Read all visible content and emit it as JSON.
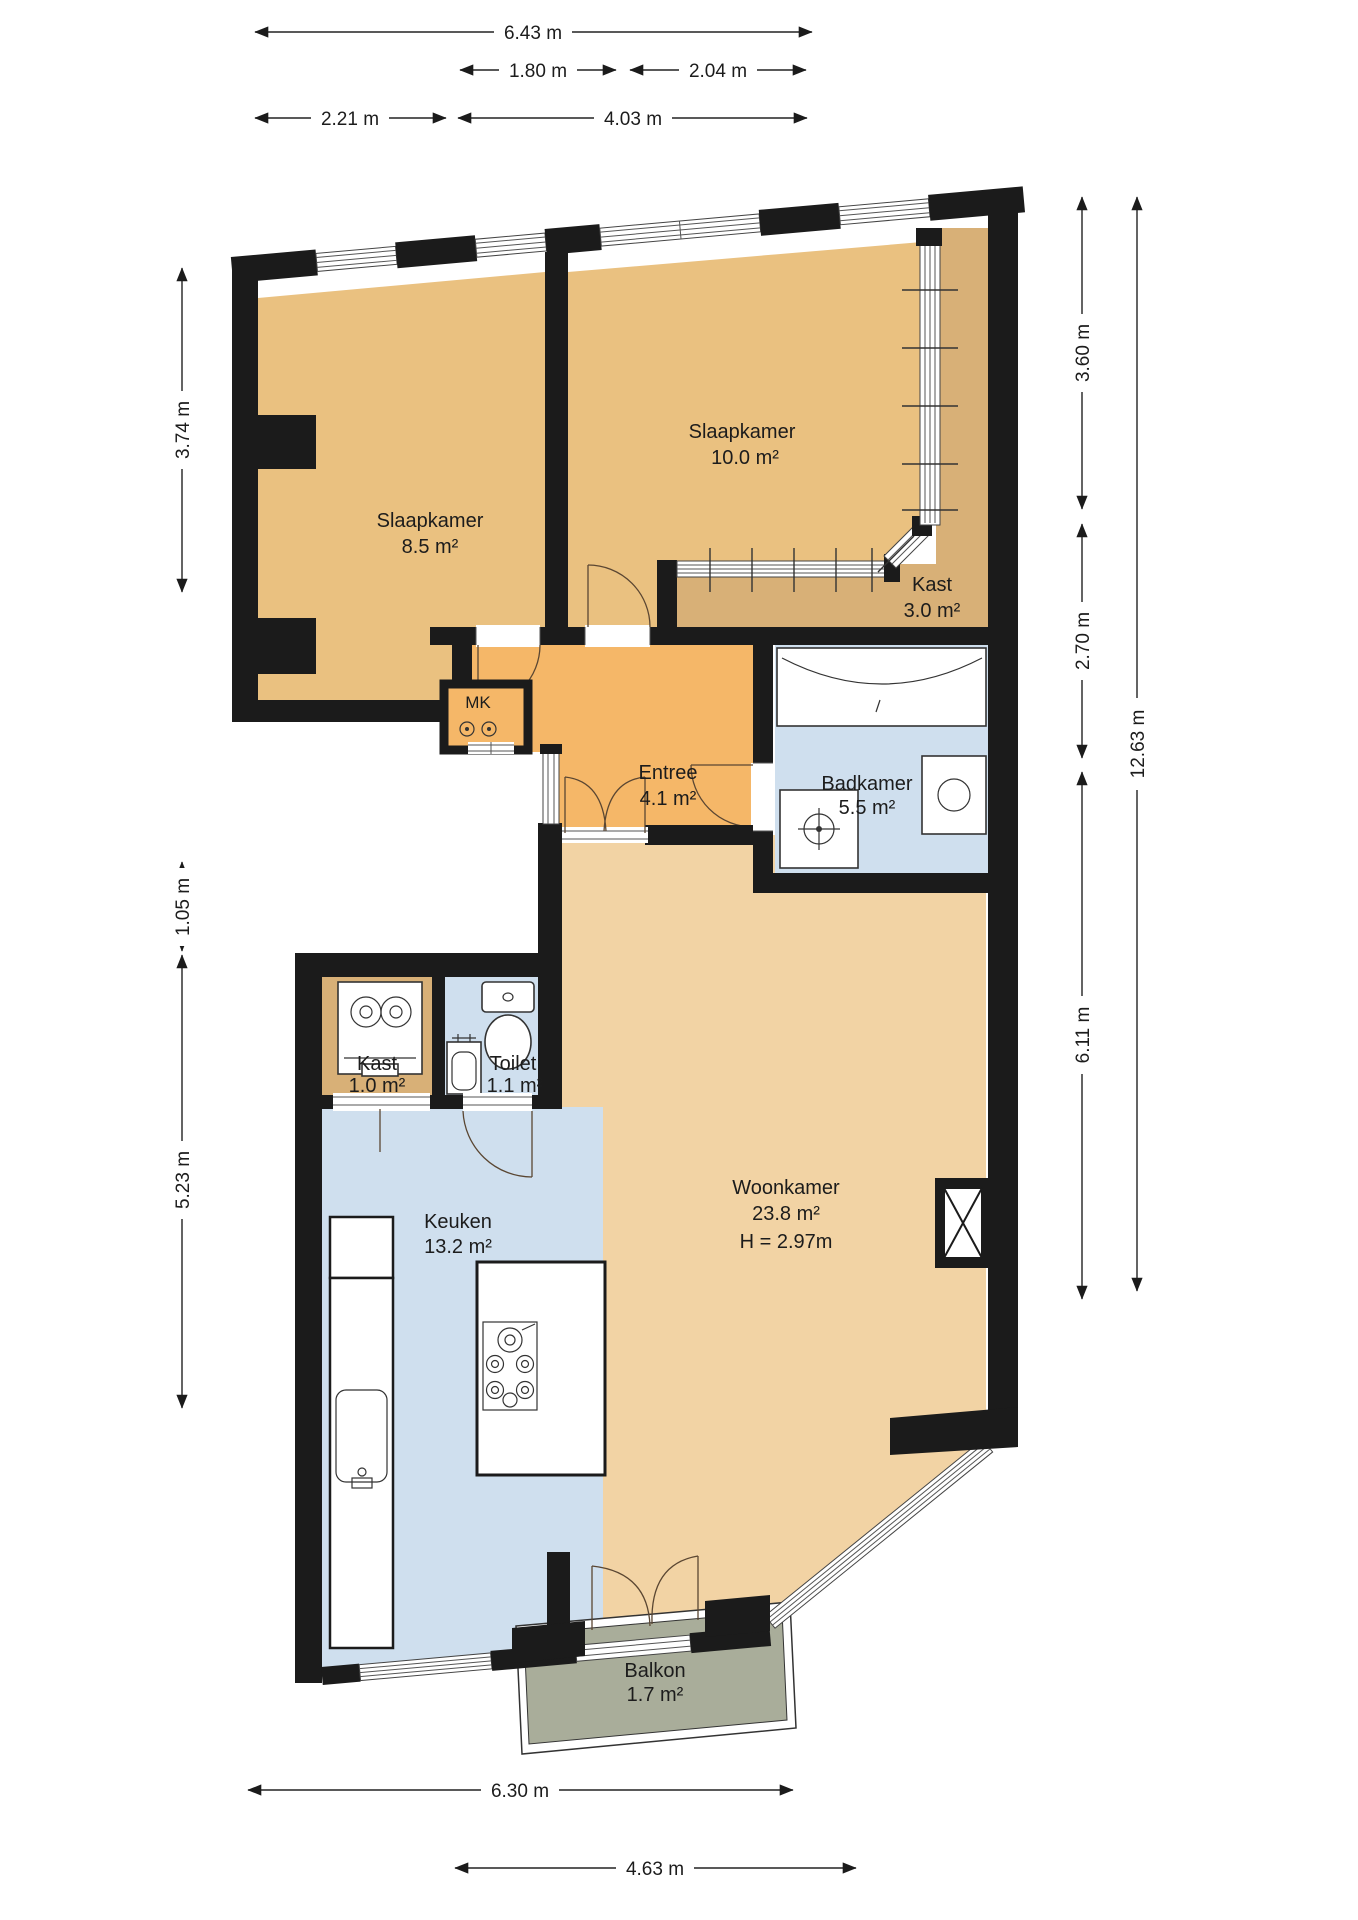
{
  "title": "Floor plan apartment (Dutch labels)",
  "colors": {
    "wall": "#1b1b1b",
    "floor_tan": "#eac180",
    "floor_tan_light": "#f2d3a4",
    "floor_orange": "#f5b768",
    "floor_dark_tan": "#d8b077",
    "floor_blue": "#cfdfee",
    "balcony_green": "#a9ad9a",
    "background": "#ffffff"
  },
  "rooms": {
    "slaapkamer_1": {
      "name": "Slaapkamer",
      "area": "10.0 m²"
    },
    "slaapkamer_2": {
      "name": "Slaapkamer",
      "area": "8.5 m²"
    },
    "kast_boven": {
      "name": "Kast",
      "area": "3.0 m²"
    },
    "entree": {
      "name": "Entree",
      "area": "4.1 m²"
    },
    "badkamer": {
      "name": "Badkamer",
      "area": "5.5 m²"
    },
    "meterkast": {
      "name": "MK"
    },
    "kast_onder": {
      "name": "Kast",
      "area": "1.0 m²"
    },
    "toilet": {
      "name": "Toilet",
      "area": "1.1 m²"
    },
    "keuken": {
      "name": "Keuken",
      "area": "13.2 m²"
    },
    "woonkamer": {
      "name": "Woonkamer",
      "area": "23.8 m²",
      "ceiling_height": "H = 2.97m"
    },
    "balkon": {
      "name": "Balkon",
      "area": "1.7 m²"
    }
  },
  "dimensions": {
    "top": [
      {
        "label": "6.43 m"
      },
      {
        "label": "1.80 m"
      },
      {
        "label": "2.04 m"
      },
      {
        "label": "2.21 m"
      },
      {
        "label": "4.03 m"
      }
    ],
    "left": [
      {
        "label": "3.74 m"
      },
      {
        "label": "1.05 m"
      },
      {
        "label": "5.23 m"
      }
    ],
    "right": [
      {
        "label": "3.60 m"
      },
      {
        "label": "2.70 m"
      },
      {
        "label": "6.11 m"
      },
      {
        "label": "12.63 m"
      }
    ],
    "bottom": [
      {
        "label": "6.30 m"
      },
      {
        "label": "4.63 m"
      }
    ]
  }
}
